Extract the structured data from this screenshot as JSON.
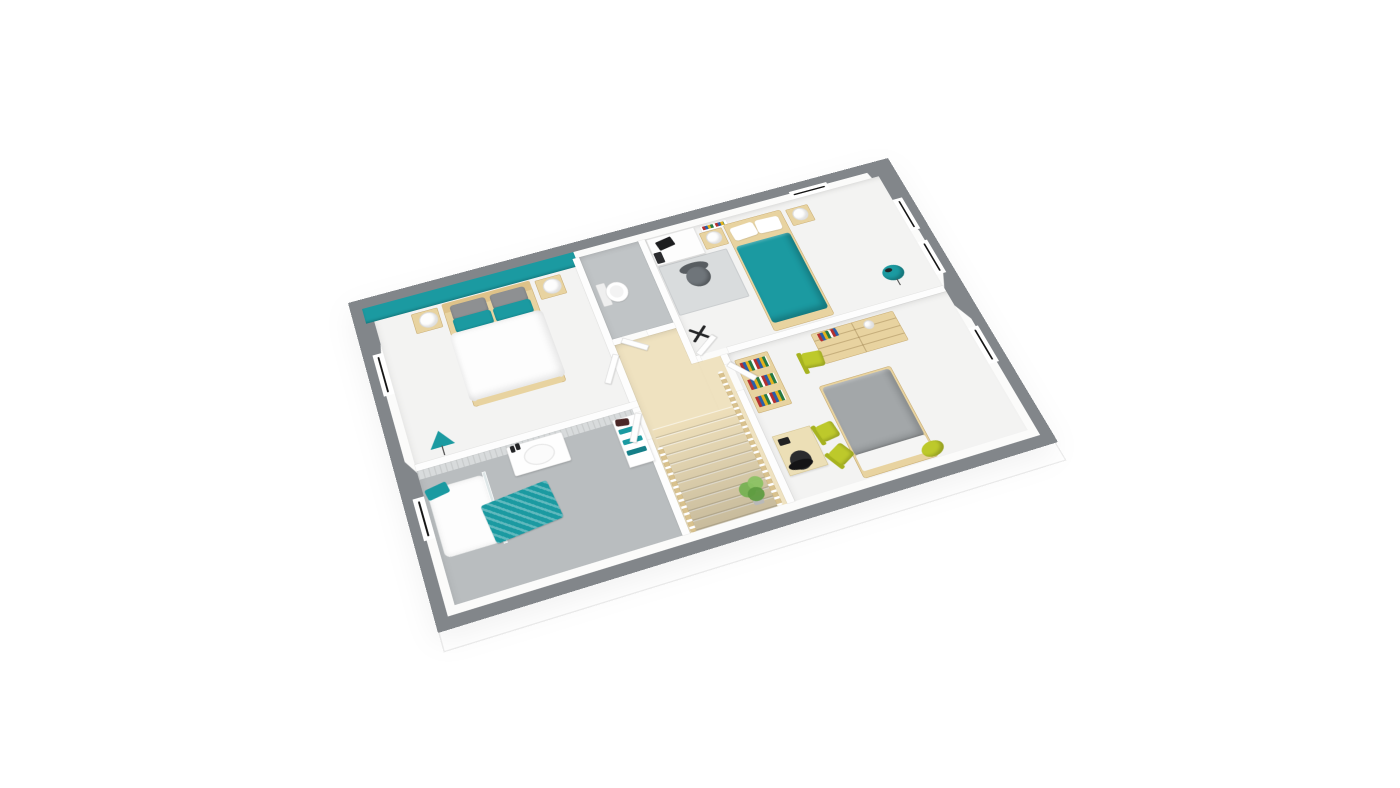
{
  "scene": {
    "kind": "3d-isometric-floor-plan-render",
    "floor_shown": "upper-floor-with-staircase",
    "background_color": "#ffffff",
    "visible_text": "",
    "outer_walls": "gray-capped cut walls with window openings",
    "window_count": 6,
    "room_count": 6
  },
  "palette": {
    "teal": "#1b9aa1",
    "teal_dark": "#157f88",
    "wall_gray": "#82868a",
    "wall_face": "#fbfbfa",
    "floor_white": "#f3f3f2",
    "floor_gray": "#b9bdbf",
    "wood": "#e8d3a0",
    "wood_dark": "#c9ad74",
    "floor_wood": "#efe2c0",
    "stair_line": "#d5bf8f",
    "chartreuse": "#bdc92b",
    "chartreuse_dark": "#a6b21f",
    "chair_gray": "#6f757a",
    "bed_gray": "#a3a7a9",
    "plant_green": "#76b152",
    "dark": "#232426",
    "white": "#ffffff",
    "glass": "#dfe7e8",
    "slab_line": "#ececec",
    "rug_gray": "#d9dcdd",
    "wainscot": "#d8dbdc"
  },
  "rooms": [
    {
      "name": "master-bedroom",
      "position": "top-left",
      "accent_wall_color": "#1b9aa1",
      "furniture": [
        "double-bed-white-duvet",
        "wood-headboard",
        "gray-cushions",
        "teal-pillows",
        "nightstand-left",
        "nightstand-right",
        "round-lamp-left",
        "round-lamp-right",
        "teal-tripod-lamp"
      ]
    },
    {
      "name": "bathroom",
      "position": "bottom-left",
      "floor_color": "#b9bdbf",
      "furniture": [
        "shower-tray",
        "glass-panel",
        "shower-head",
        "teal-towel",
        "wall-hung-vanity-sink",
        "black-bottles",
        "teal-striped-rug",
        "white-towel-shelf-with-teal-towels"
      ]
    },
    {
      "name": "wc",
      "position": "center-top",
      "floor_color": "#c0c4c6",
      "furniture": [
        "toilet"
      ]
    },
    {
      "name": "bedroom-2",
      "position": "top-right",
      "furniture": [
        "single-bed-teal-duvet",
        "white-pillows",
        "nightstand-left",
        "nightstand-right",
        "round-lamps",
        "white-desk",
        "computer-monitor",
        "computer-tower",
        "gray-office-chair",
        "gray-rug",
        "wall-shelf-books",
        "teal-floor-lamp"
      ]
    },
    {
      "name": "bedroom-3",
      "position": "bottom-right",
      "furniture": [
        "double-bed-gray-duvet",
        "white-sheet-fold",
        "wood-dresser",
        "books-on-dresser",
        "wood-bookshelf",
        "chartreuse-chair-1",
        "wood-desk",
        "black-office-chair",
        "chartreuse-chair-2",
        "chartreuse-chair-3",
        "chartreuse-pouf"
      ]
    },
    {
      "name": "hallway-landing",
      "position": "center",
      "furniture": [
        "wood-staircase-down",
        "balustrade-east",
        "balustrade-west",
        "x-folding-stool",
        "white-teal-shelf-trolley",
        "potted-plant"
      ]
    }
  ]
}
